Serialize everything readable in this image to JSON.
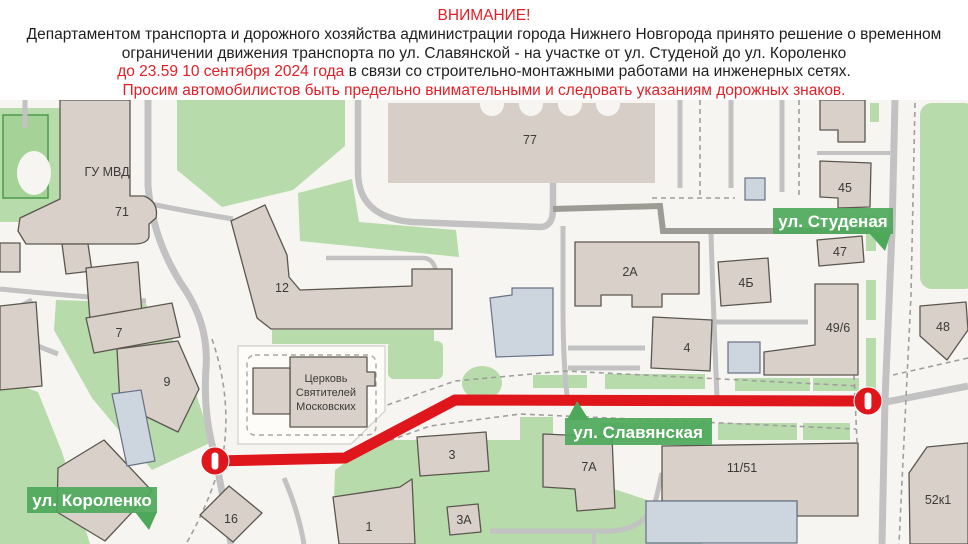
{
  "header": {
    "line1": "ВНИМАНИЕ!",
    "line2": "Департаментом транспорта и дорожного хозяйства администрации города Нижнего Новгорода принято решение о временном",
    "line3": "ограничении движения транспорта по ул. Славянской - на участке от ул. Студеной до ул. Короленко",
    "line4_red": "до 23.59 10 сентября 2024 года",
    "line4_black": " в связи со строительно-монтажными работами на инженерных сетях.",
    "line5": "Просим автомобилистов быть предельно внимательными и следовать указаниям дорожных знаков."
  },
  "map": {
    "streets": {
      "studenaya": "ул. Студеная",
      "slavyanskaya": "ул. Славянская",
      "korolenko": "ул. Короленко"
    },
    "buildings": {
      "gu_mvd": "ГУ МВД",
      "b71": "71",
      "b77": "77",
      "b12": "12",
      "b7": "7",
      "b9": "9",
      "b2a": "2А",
      "b4": "4",
      "b4b": "4Б",
      "b45": "45",
      "b47": "47",
      "b48": "48",
      "b49_6": "49/6",
      "b52k1": "52к1",
      "b11_51": "11/51",
      "b7a": "7А",
      "b3": "3",
      "b3a": "3А",
      "b1": "1",
      "b16": "16"
    },
    "church": {
      "line1": "Церковь",
      "line2": "Святителей",
      "line3": "Московских"
    },
    "colors": {
      "route_red": "#e0161d",
      "street_label_green": "#4da85a",
      "park_green": "#b7dbaa",
      "building_fill": "#d9d0c9",
      "service_blue": "#cdd5df",
      "notice_red": "#e31e24"
    }
  }
}
